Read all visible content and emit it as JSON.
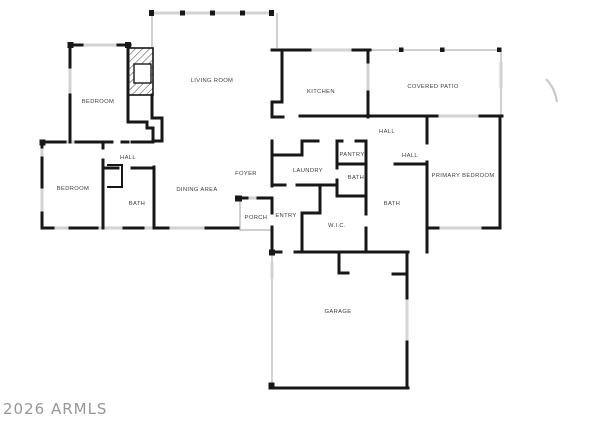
{
  "watermark": "2026 ARMLS",
  "plan": {
    "type": "floor-plan",
    "rooms": [
      {
        "label": "BEDROOM",
        "x": 98,
        "y": 101
      },
      {
        "label": "LIVING ROOM",
        "x": 212,
        "y": 80
      },
      {
        "label": "KITCHEN",
        "x": 321,
        "y": 91
      },
      {
        "label": "COVERED PATIO",
        "x": 433,
        "y": 86
      },
      {
        "label": "HALL",
        "x": 387,
        "y": 131
      },
      {
        "label": "HALL",
        "x": 410,
        "y": 155
      },
      {
        "label": "PRIMARY BEDROOM",
        "x": 463,
        "y": 175
      },
      {
        "label": "BEDROOM",
        "x": 73,
        "y": 188
      },
      {
        "label": "HALL",
        "x": 128,
        "y": 157
      },
      {
        "label": "BATH",
        "x": 137,
        "y": 203
      },
      {
        "label": "DINING AREA",
        "x": 197,
        "y": 189
      },
      {
        "label": "FOYER",
        "x": 246,
        "y": 173
      },
      {
        "label": "LAUNDRY",
        "x": 308,
        "y": 170
      },
      {
        "label": "PANTRY",
        "x": 352,
        "y": 154
      },
      {
        "label": "BATH",
        "x": 356,
        "y": 177
      },
      {
        "label": "BATH",
        "x": 392,
        "y": 203
      },
      {
        "label": "W.I.C.",
        "x": 337,
        "y": 225
      },
      {
        "label": "ENTRY",
        "x": 286,
        "y": 215
      },
      {
        "label": "PORCH",
        "x": 256,
        "y": 217
      },
      {
        "label": "GARAGE",
        "x": 338,
        "y": 311
      }
    ],
    "features": [
      "fireplace",
      "garage-door",
      "windows",
      "patio-posts"
    ],
    "colors": {
      "wall": "#171717",
      "window": "#d2d2d2",
      "thin_line": "#b2b2b2",
      "label": "#3d3d3d",
      "watermark": "#979797"
    }
  }
}
